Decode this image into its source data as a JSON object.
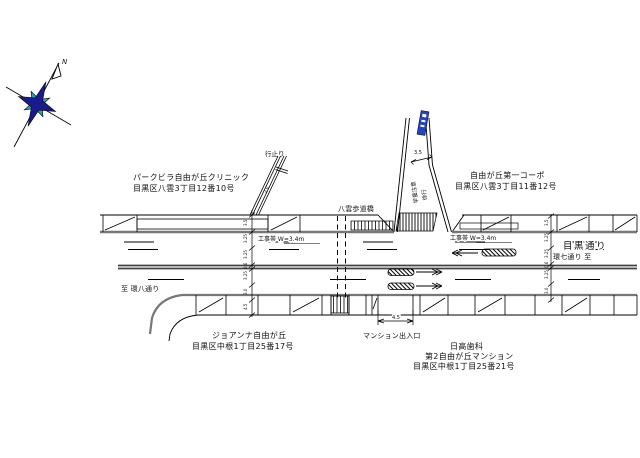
{
  "compass": {
    "north_label": "N",
    "star_primary_color": "#1a1a8c",
    "star_secondary_color": "#1fa8b4"
  },
  "streets": {
    "main_road_name": "目黒通り",
    "direction_west": "至 環八通り",
    "direction_east": "環七通り 至",
    "footbridge": "八雲歩道橋",
    "dead_end": "行止り",
    "entrance": "マンション出入口"
  },
  "buildings": {
    "clinic": {
      "name": "パークビラ自由が丘クリニック",
      "address": "目黒区八雲3丁目12番10号"
    },
    "corpo": {
      "name": "自由が丘第一コーポ",
      "address": "目黒区八雲3丁目11番12号"
    },
    "joanna": {
      "name": "ジョアンナ自由が丘",
      "address": "目黒区中根1丁目25番17号"
    },
    "hidaka": {
      "name": "日高歯科",
      "building": "第2自由が丘マンション",
      "address": "目黒区中根1丁目25番21号"
    }
  },
  "annotations": {
    "work_zone_left": "工事帯 W=3.4m",
    "work_zone_right": "工事帯 W=3.4m",
    "road_marking_1": "学童注意",
    "road_marking_2": "徐行",
    "sign_color": "#2343c3"
  },
  "dimensions": {
    "side_street_width": "3.5",
    "dead_end_width": "2.0",
    "entrance_width": "4.5",
    "left_ticks": [
      "3.5",
      "3.25",
      "3.25",
      "0.6",
      "3.25",
      "3.0",
      "4.5"
    ],
    "right_ticks": [
      "3.5",
      "3.25",
      "3.25",
      "0.6",
      "3.25",
      "3.0"
    ]
  }
}
